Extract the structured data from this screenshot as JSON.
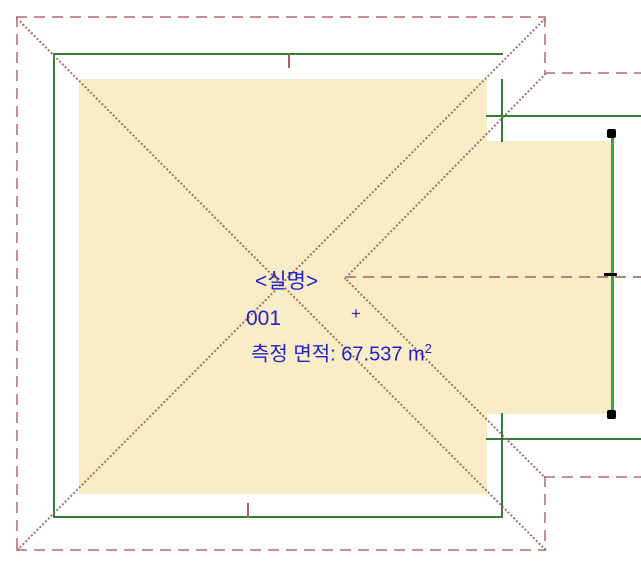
{
  "zone": {
    "name": "<실명>",
    "number": "001",
    "area_prefix": "측정 면적: 67.537 m",
    "area_exponent": "2",
    "origin_marker": "+"
  },
  "colors": {
    "zone_fill": "#f9edc7",
    "zone_text": "#2222cc",
    "zone_edge": "#3aa53a",
    "selection_handle": "#000000",
    "boundary_dash": "#c59090",
    "diagonal_dots": "#a5706a",
    "centerline_dash": "#b5827a",
    "wall_insulation_hatch": "#3f8e3f",
    "wall_structure_hatch": "#c9544a",
    "wall_face_line": "#8e1a10",
    "wall_separator_line": "#93931c",
    "wall_outer_line": "#c79292",
    "wall_junction_line": "#b0625a"
  }
}
